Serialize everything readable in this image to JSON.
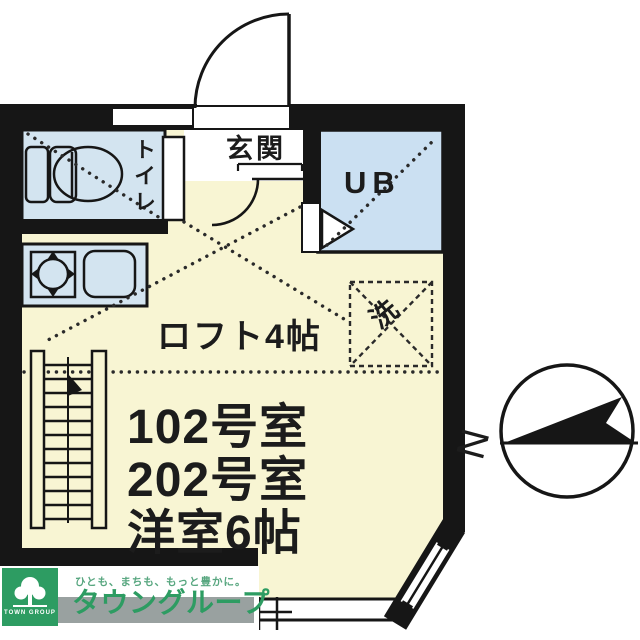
{
  "plan": {
    "rooms": {
      "entrance_label": "玄関",
      "toilet_label": "トイレ",
      "unit_bath_label": "UB",
      "washer_label": "洗",
      "loft_label": "ロフト4帖",
      "unit_line1": "102号室",
      "unit_line2": "202号室",
      "unit_line3": "洋室6帖"
    },
    "compass": {
      "north_label": "N"
    },
    "colors": {
      "floor": "#f8f5d3",
      "wet_area": "#d3e4f0",
      "bath": "#cbe0f2",
      "wall": "#161616"
    }
  },
  "branding": {
    "tagline": "ひとも、まちも、もっと豊かに。",
    "company_name": "タウングループ",
    "logo_caption": "TOWN GROUP",
    "brand_green": "#2d9c62"
  }
}
